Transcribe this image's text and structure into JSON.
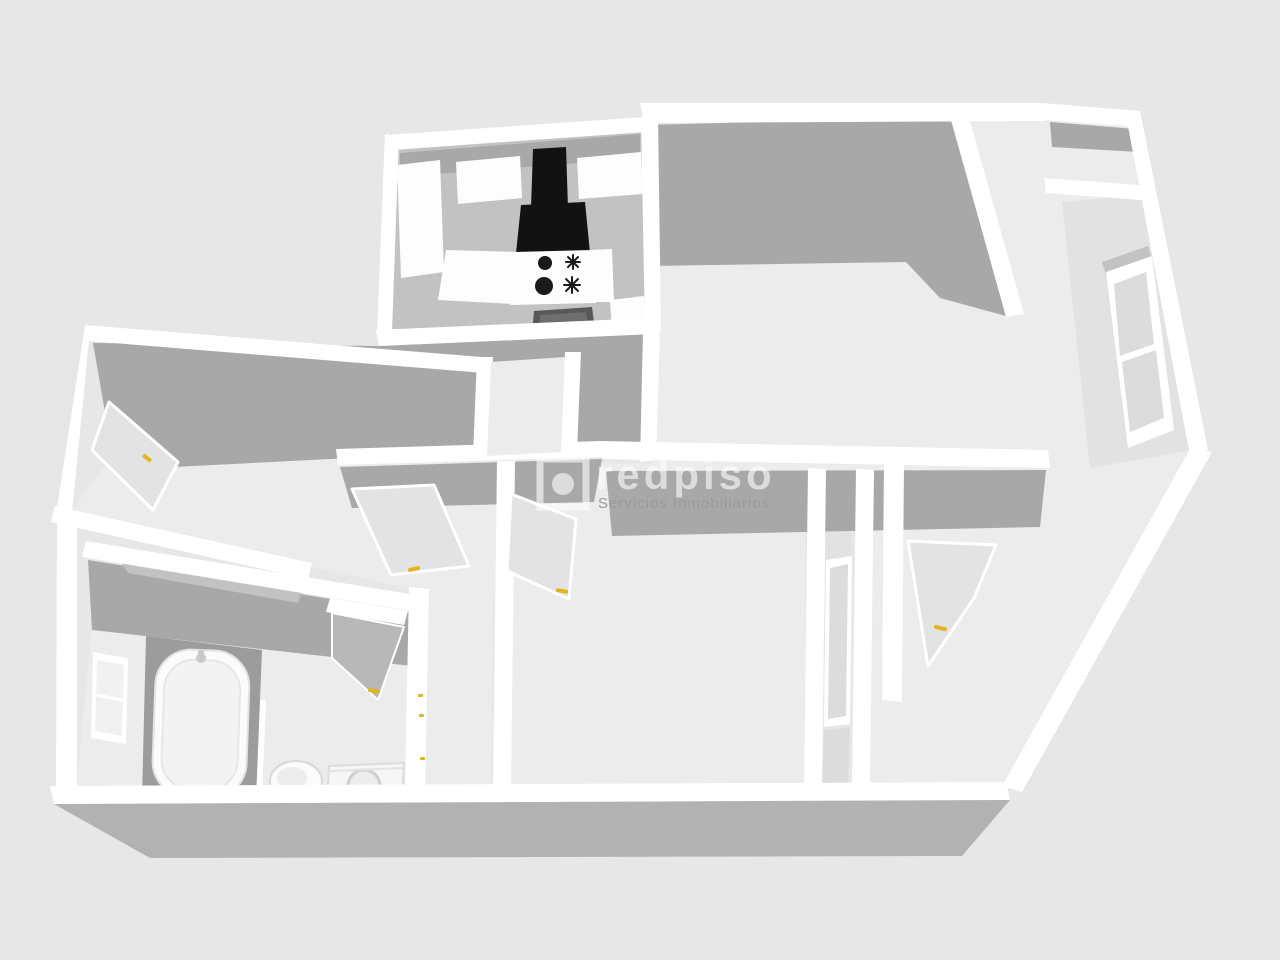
{
  "scene": {
    "type": "3d-floorplan-render",
    "description": "Grayscale 3D dollhouse-style floor plan of an apartment seen from above at an angle",
    "rooms": [
      {
        "id": "kitchen",
        "evidence": "range hood, cooktop, oven, cabinets, window"
      },
      {
        "id": "living-room-top-right",
        "evidence": "large empty room with corner closet nook and window on right wall"
      },
      {
        "id": "room-left",
        "evidence": "room with open door with yellow handle"
      },
      {
        "id": "hallway-center",
        "evidence": "corridor with three open doors with yellow handles"
      },
      {
        "id": "bathroom-bottom-left",
        "evidence": "bathtub, toilet, washing machine, window"
      },
      {
        "id": "bedroom-bottom-right",
        "evidence": "room with open door with yellow handle and glazed wall panels"
      }
    ],
    "fixtures": [
      {
        "id": "range-hood",
        "color_key": "hood"
      },
      {
        "id": "solid-burners",
        "count": 2
      },
      {
        "id": "gas-burner-symbols",
        "count": 2
      },
      {
        "id": "oven",
        "color_key": "oven"
      },
      {
        "id": "bathtub"
      },
      {
        "id": "toilet"
      },
      {
        "id": "washing-machine"
      }
    ],
    "doors_with_yellow_handles": 5,
    "windows": 4
  },
  "watermark": {
    "brand": "redpiso",
    "tagline": "Servicios Inmobiliarios"
  },
  "colors": {
    "background": "#e7e7e8",
    "floor": "#ececed",
    "wall_white": "#ffffff",
    "wall_shadow": "#a8a8a9",
    "tub_alcove": "#9c9c9d",
    "wall_midtone": "#c2c2c3",
    "wall_light": "#e2e2e3",
    "outer_wall": "#b2b2b3",
    "hood": "#121212",
    "oven": "#585858",
    "window_pane": "#dcdcdd",
    "door_face": "#e3e3e4",
    "door_dark": "#b8b8b9",
    "handle_yellow": "#e3b322",
    "watermark_white": "rgba(255,255,255,0.6)",
    "tagline_gray": "#9a9a9b"
  }
}
